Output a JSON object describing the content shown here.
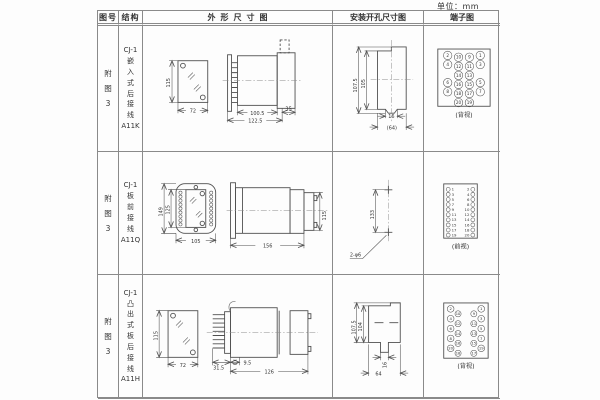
{
  "colors": {
    "ink": "#4f4f4f",
    "grid_line": "#8a8a8a",
    "text": "#333333",
    "background": "#fdfdfd"
  },
  "page": {
    "unit_label": "单位：mm"
  },
  "table": {
    "headers": {
      "fig_no": "图号",
      "structure": "结构",
      "outline": "外形尺寸图",
      "install": "安装开孔尺寸图",
      "terminal": "端子图"
    }
  },
  "rows": [
    {
      "fig_no": [
        "附",
        "图",
        "3"
      ],
      "structure": [
        "CJ-1",
        "嵌",
        "入",
        "式",
        "后",
        "接",
        "线",
        "A11K"
      ],
      "outline": {
        "front_h": "115",
        "front_w": "72",
        "side_top": "100.5",
        "side_bottom": "122.5",
        "side_right": "35"
      },
      "install": {
        "outer_h": "107.5",
        "inner_h": "105",
        "notch_w": "16",
        "span_w": "(64)"
      },
      "terminal": {
        "view": "(背视)",
        "grid": [
          [
            "2",
            "10",
            "9",
            "1"
          ],
          [
            "4",
            "12",
            "11",
            "3"
          ],
          [
            "",
            "14",
            "13",
            ""
          ],
          [
            "6",
            "16",
            "15",
            "5"
          ],
          [
            "8",
            "18",
            "17",
            "7"
          ],
          [
            "",
            "20",
            "19",
            ""
          ]
        ]
      }
    },
    {
      "fig_no": [
        "附",
        "图",
        "3"
      ],
      "structure": [
        "CJ-1",
        "板",
        "前",
        "接",
        "线",
        "A11Q"
      ],
      "outline": {
        "front_h_outer": "149",
        "front_h_inner": "125",
        "front_w": "105",
        "side_w": "156",
        "side_h": "115"
      },
      "install": {
        "span_v": "133",
        "hole": "2-φ6"
      },
      "terminal": {
        "view": "(前视)",
        "left": [
          "1",
          "3",
          "5",
          "7",
          "9",
          "11",
          "13",
          "15",
          "17",
          "19"
        ],
        "right": [
          "2",
          "4",
          "6",
          "8",
          "10",
          "12",
          "14",
          "16",
          "18",
          "20"
        ]
      }
    },
    {
      "fig_no": [
        "附",
        "图",
        "3"
      ],
      "structure": [
        "CJ-1",
        "凸",
        "出",
        "式",
        "板",
        "后",
        "接",
        "线",
        "A11H"
      ],
      "outline": {
        "front_h": "115",
        "front_w": "72",
        "side_d1": "31.5",
        "side_d2": "9.5",
        "side_d3": "126"
      },
      "install": {
        "outer_h": "107.5",
        "inner_h": "104",
        "slot_w": "16",
        "span_w": "64"
      },
      "terminal": {
        "view": "(背视)",
        "left_pairs": [
          [
            "2",
            "10"
          ],
          [
            "4",
            "12"
          ],
          [
            "6",
            "14"
          ],
          [
            "8",
            "16"
          ],
          [
            "20",
            "18"
          ]
        ],
        "right_pairs": [
          [
            "1",
            "9"
          ],
          [
            "3",
            "11"
          ],
          [
            "5",
            "13"
          ],
          [
            "7",
            "15"
          ],
          [
            "19",
            "17"
          ]
        ]
      }
    }
  ]
}
